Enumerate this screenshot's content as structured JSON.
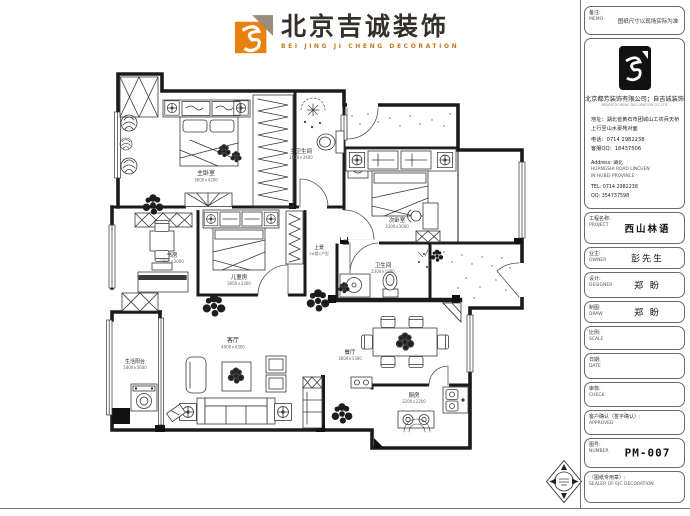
{
  "header": {
    "brand_cn": "北京吉诚装饰",
    "brand_en": "BEI JING JI CHENG DECORATION"
  },
  "colors": {
    "brand_orange": "#E8820D",
    "brand_taupe": "#9B8C7C",
    "wall_ink": "#1B1B1B"
  },
  "title_block": {
    "memo": {
      "cn": "备注:",
      "en": "MEMO",
      "text": "图纸尺寸以现场实际为准"
    },
    "company": {
      "name": "北京都芳装饰有限公司；自吉诚装饰",
      "name_en": "BEIJING JICHENG DECORATION CO.,LTD",
      "addr1": "地址：湖北省黄石市团城山工农兵天桥",
      "addr2": "上行至山水豪苑对面",
      "phone": "电话：0714 2982238",
      "qq": "客服QQ：18437506",
      "addr_en_label": "Address: 湖北",
      "addr_en1": "HUANGSHI ROAD LINCHEN",
      "addr_en2": "IN HUBEI PROVINCE",
      "tel_en": "TEL: 0714 2982238",
      "qq_en": "QQ: 354737598"
    },
    "rows": [
      {
        "cn": "工程名称:",
        "en": "PROJECT",
        "value": "西山林语"
      },
      {
        "cn": "业主:",
        "en": "OWNER",
        "value": "彭先生"
      },
      {
        "cn": "设计:",
        "en": "DESIGNER",
        "value": "郑  盼"
      },
      {
        "cn": "制图:",
        "en": "DRAW",
        "value": "郑  盼"
      },
      {
        "cn": "比例:",
        "en": "SCALE",
        "value": ""
      },
      {
        "cn": "日期:",
        "en": "DATE",
        "value": ""
      },
      {
        "cn": "审核:",
        "en": "CHECK",
        "value": ""
      },
      {
        "cn": "客户确认（签字确认）:",
        "en": "APPROVED",
        "value": ""
      },
      {
        "cn": "图号:",
        "en": "NUMBER",
        "value": "PM-007"
      },
      {
        "cn": "（图纸专用章）:",
        "en": "SEALER OF EJC DECORATION",
        "value": ""
      }
    ]
  },
  "plan": {
    "rooms": [
      {
        "name": "主卧室",
        "size": "3600×4200"
      },
      {
        "name": "主卫生间",
        "size": "1900×3400"
      },
      {
        "name": "次卧室",
        "size": "3300×3000"
      },
      {
        "name": "儿童房",
        "size": "3000×3300"
      },
      {
        "name": "书房",
        "size": "2800×3000"
      },
      {
        "name": "卫生间",
        "size": "2300×1800"
      },
      {
        "name": "客厅",
        "size": "4900×4300"
      },
      {
        "name": "餐厅",
        "size": "3600×3300"
      },
      {
        "name": "厨房",
        "size": "3200×2200"
      },
      {
        "name": "生活阳台",
        "size": "1800×5600"
      },
      {
        "name": "上景",
        "size": "3#楼C户型"
      }
    ]
  }
}
